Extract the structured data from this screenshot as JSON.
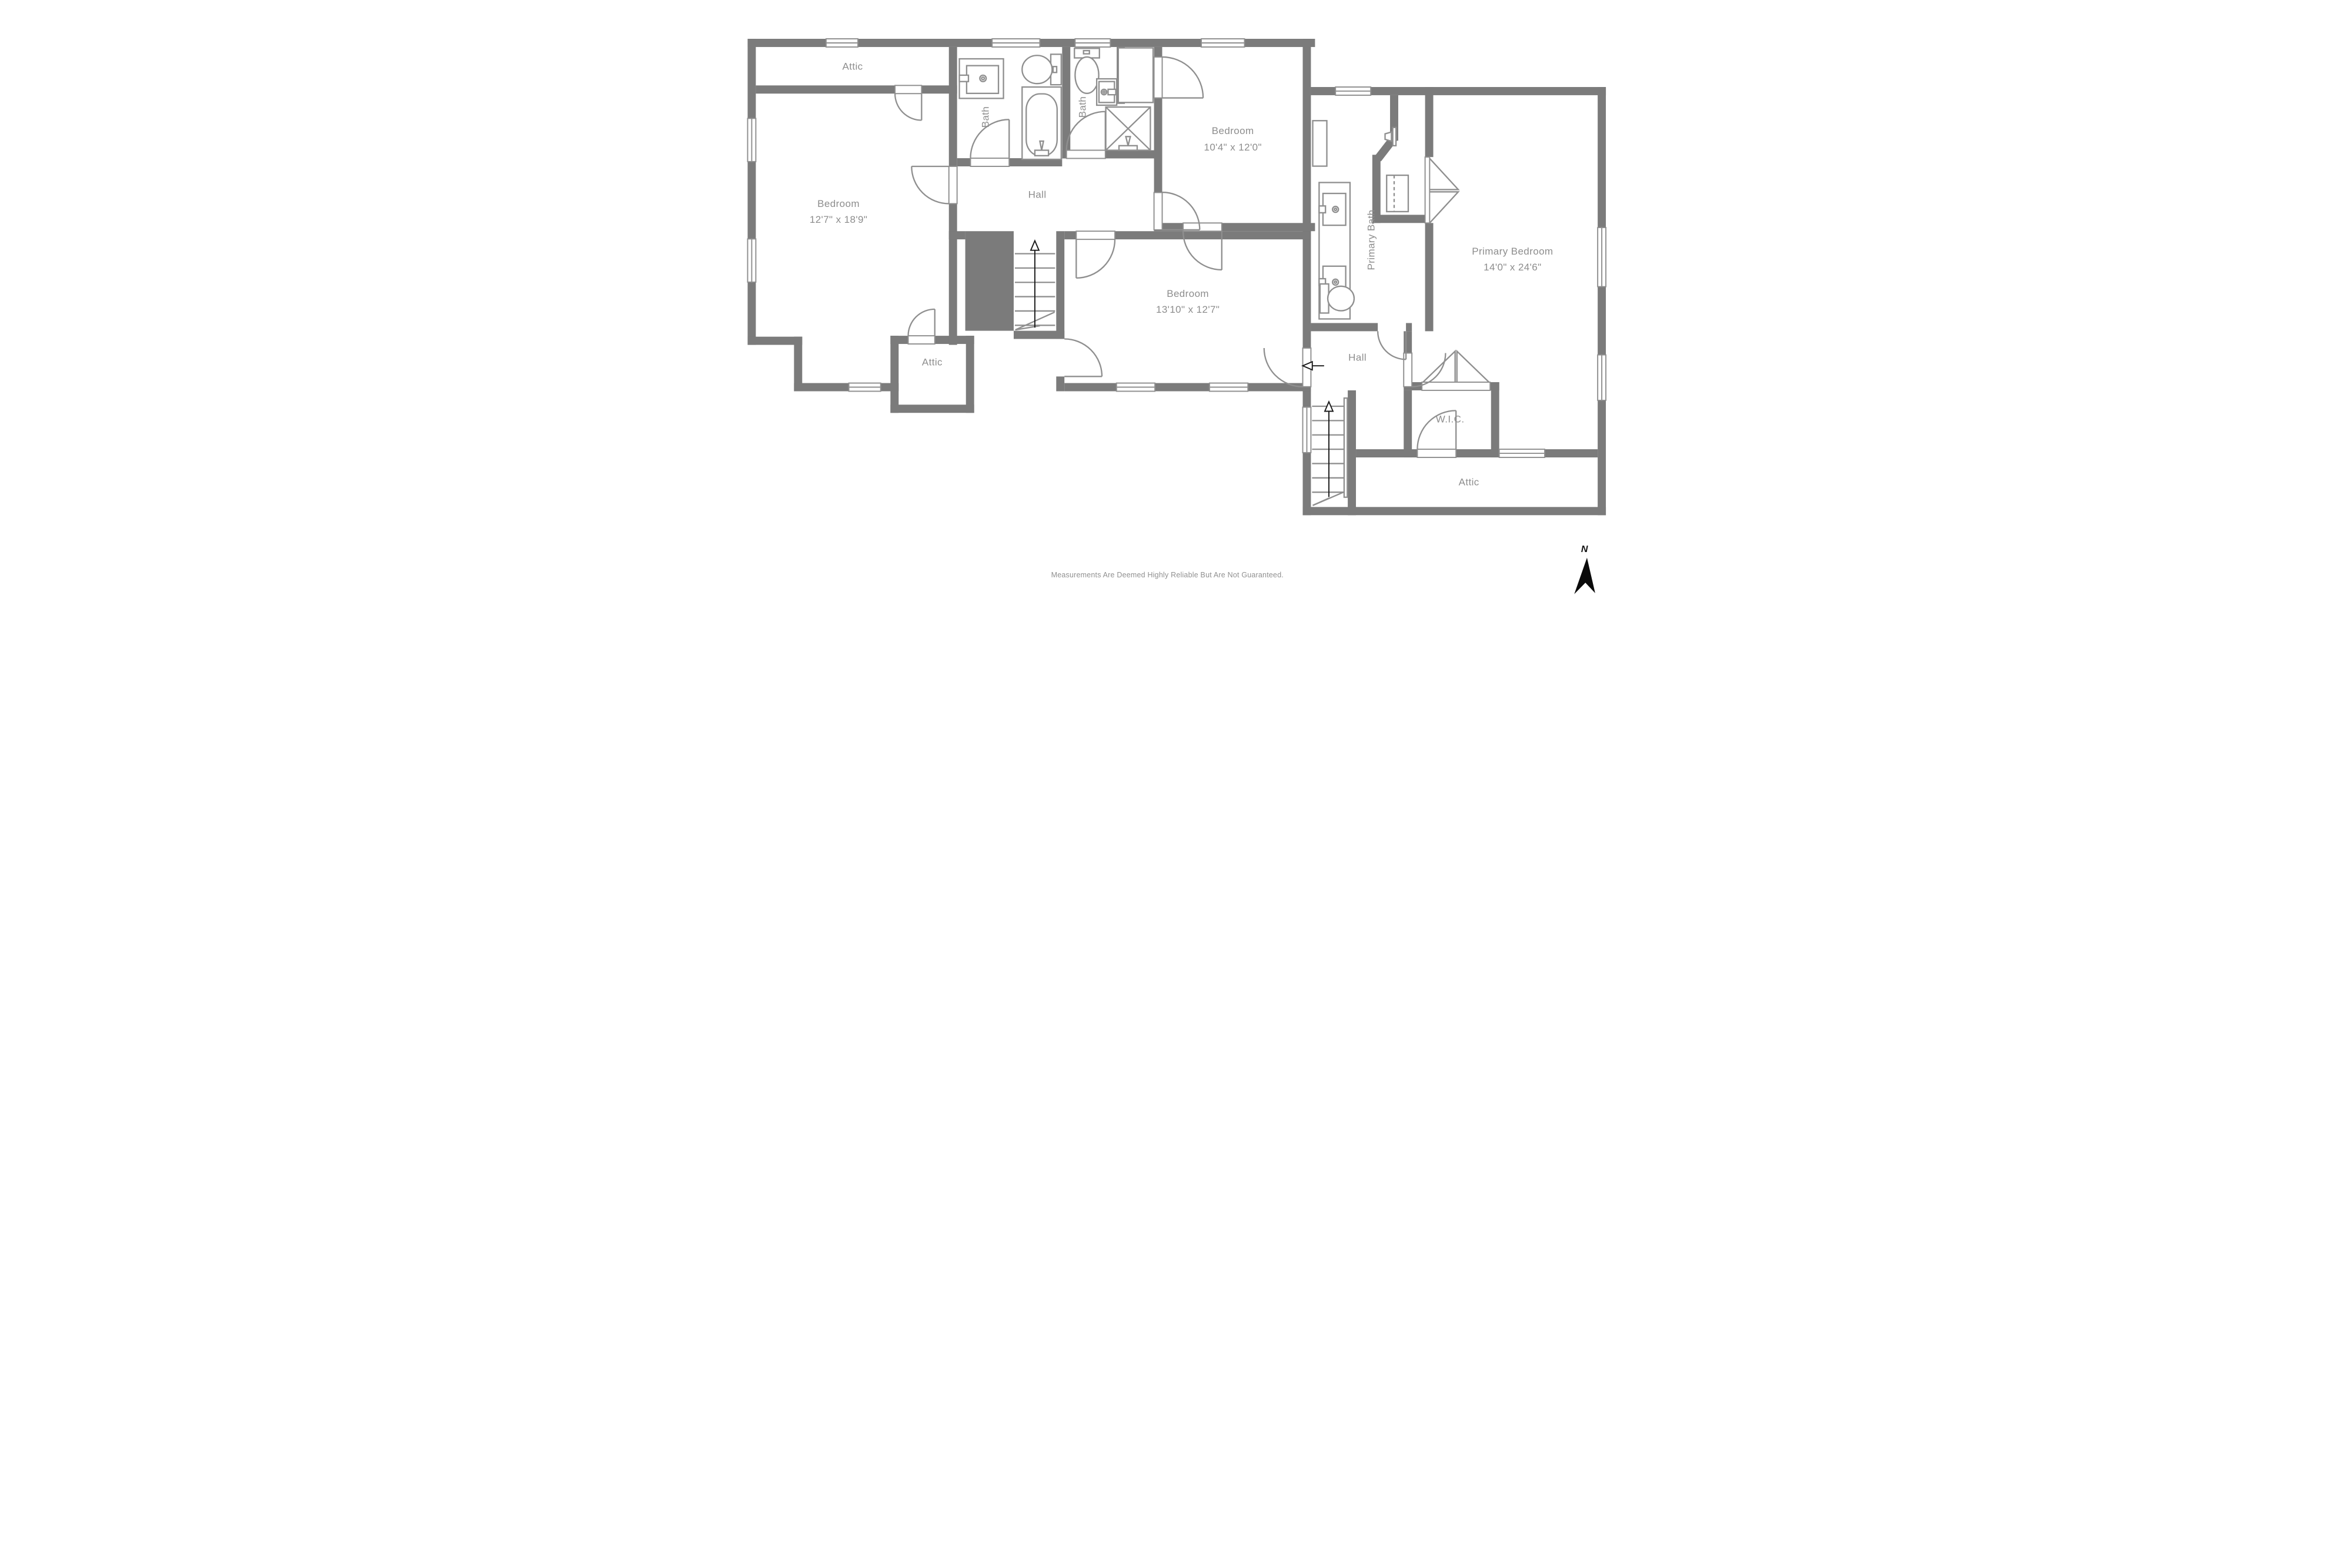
{
  "plan": {
    "rooms": [
      {
        "id": "attic-top-left",
        "label": "Attic"
      },
      {
        "id": "bath-1",
        "label": "Bath"
      },
      {
        "id": "bath-2",
        "label": "Bath"
      },
      {
        "id": "bedroom-top-right",
        "label": "Bedroom",
        "dims": "10'4\" x 12'0\""
      },
      {
        "id": "hall-center",
        "label": "Hall"
      },
      {
        "id": "bedroom-left",
        "label": "Bedroom",
        "dims": "12'7\" x 18'9\""
      },
      {
        "id": "bedroom-center",
        "label": "Bedroom",
        "dims": "13'10\" x 12'7\""
      },
      {
        "id": "attic-middle",
        "label": "Attic"
      },
      {
        "id": "primary-bath",
        "label": "Primary Bath"
      },
      {
        "id": "primary-bedroom",
        "label": "Primary Bedroom",
        "dims": "14'0\" x 24'6\""
      },
      {
        "id": "hall-right",
        "label": "Hall"
      },
      {
        "id": "wic",
        "label": "W.I.C."
      },
      {
        "id": "attic-bottom-right",
        "label": "Attic"
      }
    ],
    "disclaimer": "Measurements Are Deemed Highly Reliable But Are Not Guaranteed.",
    "compass_label": "N",
    "colors": {
      "wall": "#7b7b7b",
      "line": "#8f8f8f",
      "label": "#8d8d8d",
      "bg": "#ffffff",
      "compass": "#0a0a0a"
    }
  }
}
